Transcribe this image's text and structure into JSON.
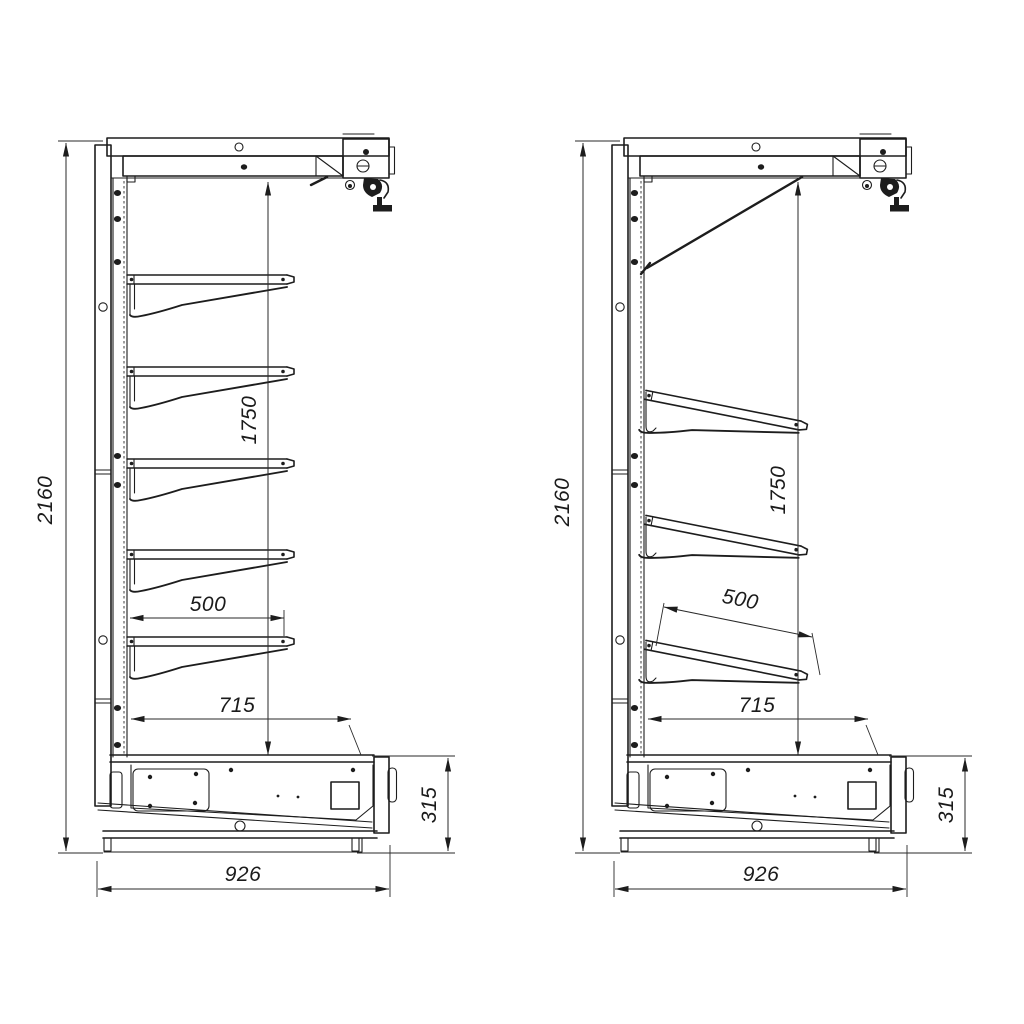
{
  "drawing": {
    "background": "#ffffff",
    "ink": "#1d1d1d",
    "views": {
      "left": {
        "id": "side-view-horizontal-shelves",
        "shelf_style": "horizontal",
        "shelf_count": 5,
        "dims": {
          "overall_height": "2160",
          "shelf_zone_height": "1750",
          "shelf_depth": "500",
          "base_top_depth": "715",
          "base_height": "315",
          "overall_depth": "926"
        }
      },
      "right": {
        "id": "side-view-inclined-shelves",
        "shelf_style": "inclined",
        "shelf_count": 3,
        "dims": {
          "overall_height": "2160",
          "shelf_zone_height": "1750",
          "shelf_depth": "500",
          "base_top_depth": "715",
          "base_height": "315",
          "overall_depth": "926"
        }
      }
    }
  }
}
